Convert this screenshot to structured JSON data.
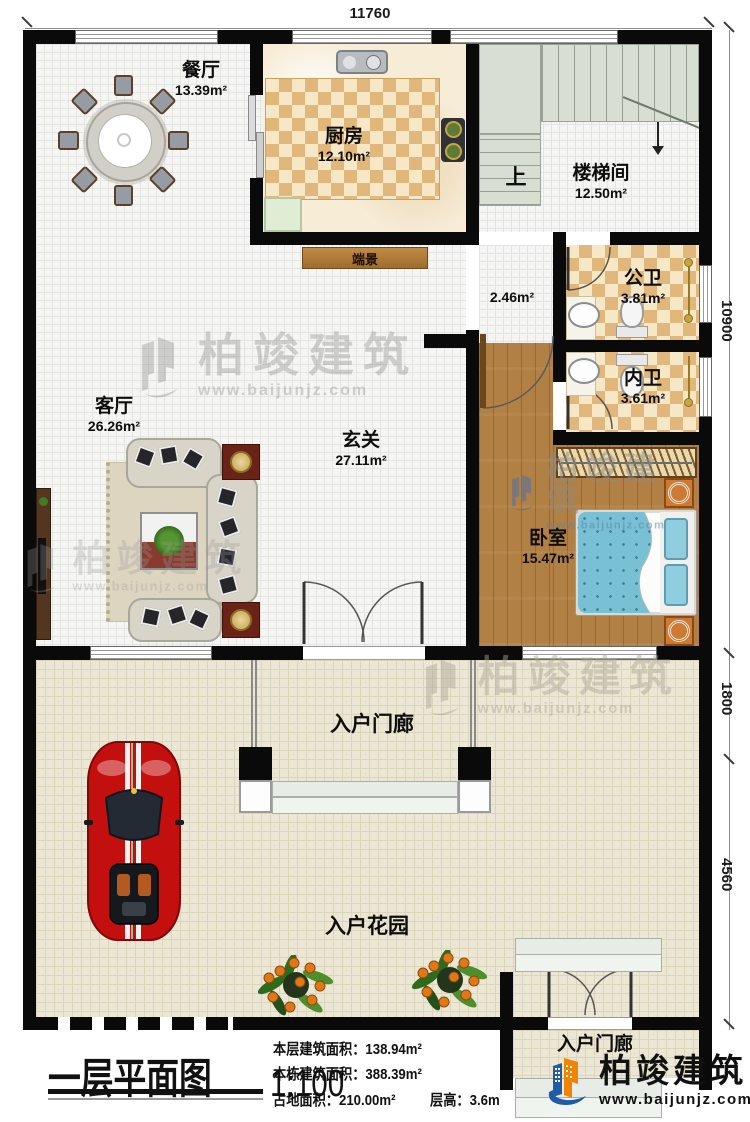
{
  "dims": {
    "top": "11760",
    "right_total": "10900",
    "right_porch": "1800",
    "right_garden": "4560"
  },
  "rooms": {
    "dining": {
      "name": "餐厅",
      "area": "13.39m²"
    },
    "kitchen": {
      "name": "厨房",
      "area": "12.10m²"
    },
    "stairwell": {
      "name": "楼梯间",
      "area": "12.50m²",
      "direction": "上"
    },
    "hallway": {
      "area": "2.46m²"
    },
    "public_bath": {
      "name": "公卫",
      "area": "3.81m²"
    },
    "private_bath": {
      "name": "内卫",
      "area": "3.61m²"
    },
    "living": {
      "name": "客厅",
      "area": "26.26m²"
    },
    "foyer": {
      "name": "玄关",
      "area": "27.11m²"
    },
    "bedroom": {
      "name": "卧室",
      "area": "15.47m²"
    },
    "console": {
      "name": "端景"
    },
    "porch": {
      "name": "入户门廊"
    },
    "garden": {
      "name": "入户花园"
    },
    "entry_porch": {
      "name": "入户门廊"
    }
  },
  "title_block": {
    "title": "一层平面图",
    "scale": "1:100",
    "stats": [
      "本层建筑面积：138.94m²",
      "本栋建筑面积：388.39m²",
      "占地面积：210.00m²",
      "层高：3.6m"
    ]
  },
  "brand": {
    "name": "柏竣建筑",
    "site": "www.baijunjz.com"
  },
  "colors": {
    "wall": "#0a0a0a",
    "kitchen_checker": "#e2b77b",
    "bedroom_wood": "#b08044",
    "bed": "#7ac0d4",
    "stair": "#d8ded2",
    "garden_floor": "#ebe7d4",
    "car": "#c40f0f",
    "logo_blue": "#1e5ca8",
    "logo_orange": "#f08300"
  }
}
